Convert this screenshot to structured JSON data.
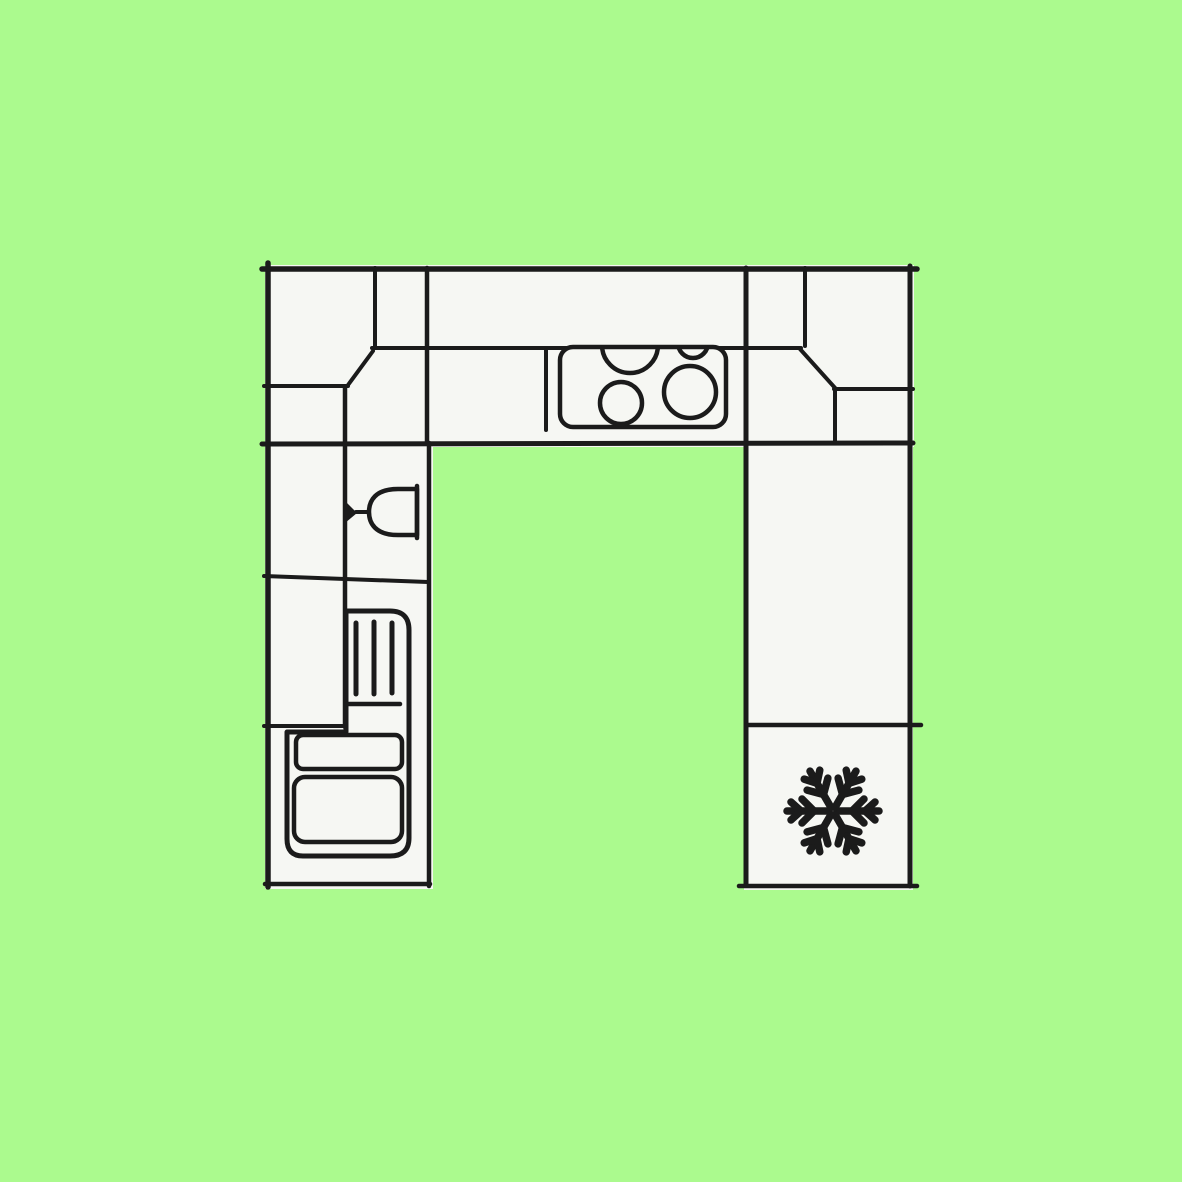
{
  "page": {
    "title": "Kitchen floor plan diagram"
  },
  "colors": {
    "background": "#abfa8e",
    "cabinet_fill": "#f6f7f3",
    "line": "#1b1b1b"
  },
  "diagram": {
    "type": "floor-plan",
    "subject": "U-shaped kitchen viewed from above",
    "regions": [
      {
        "name": "top-counter-run"
      },
      {
        "name": "left-counter-run"
      },
      {
        "name": "right-counter-run"
      }
    ],
    "fixtures": [
      {
        "name": "cooktop",
        "burner_count": 4,
        "location": "top-counter-run"
      },
      {
        "name": "wine-glass",
        "location": "left-counter-run"
      },
      {
        "name": "drawer-unit",
        "hatch_lines": 3,
        "drawer_fronts": 2,
        "location": "left-counter-run"
      },
      {
        "name": "freezer",
        "icon": "snowflake-icon",
        "location": "right-counter-run"
      }
    ]
  },
  "icons": [
    {
      "name": "snowflake-icon",
      "meaning": "freezer compartment"
    },
    {
      "name": "wine-glass-icon",
      "meaning": "glassware / sink-side fixture"
    },
    {
      "name": "burner-icon",
      "meaning": "cooktop burner"
    }
  ]
}
